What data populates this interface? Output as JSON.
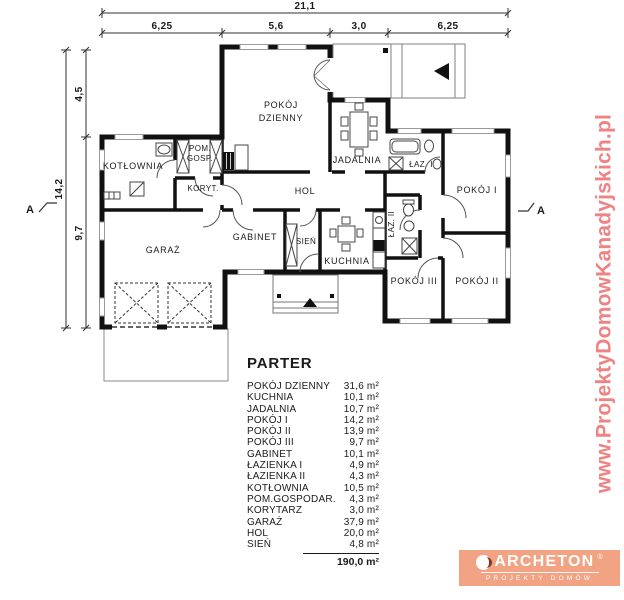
{
  "plan": {
    "rooms": {
      "pokoj_dzienny": {
        "line1": "POKÓJ",
        "line2": "DZIENNY"
      },
      "jadalnia": "JADALNIA",
      "kotlownia": "KOTŁOWNIA",
      "pom_gosp": {
        "line1": "POM.",
        "line2": "GOSP."
      },
      "koryt": "KORYT.",
      "hol": "HOL",
      "garaz": "GARAŻ",
      "gabinet": "GABINET",
      "sien": "SIEŃ",
      "kuchnia": "KUCHNIA",
      "laz1": "ŁAZ. I",
      "laz2": "ŁAZ. II",
      "pokoj1": "POKÓJ I",
      "pokoj2": "POKÓJ II",
      "pokoj3": "POKÓJ III"
    }
  },
  "dimensions": {
    "top_total": "21,1",
    "top_segments": [
      "6,25",
      "5,6",
      "3,0",
      "6,25"
    ],
    "left_total": "14,2",
    "left_segments": [
      "4,5",
      "9,7"
    ],
    "section_marker": "A"
  },
  "table": {
    "title": "PARTER",
    "rows": [
      {
        "label": "POKÓJ DZIENNY",
        "area": "31,6 m²"
      },
      {
        "label": "KUCHNIA",
        "area": "10,1 m²"
      },
      {
        "label": "JADALNIA",
        "area": "10,7 m²"
      },
      {
        "label": "POKÓJ I",
        "area": "14,2 m²"
      },
      {
        "label": "POKÓJ II",
        "area": "13,9 m²"
      },
      {
        "label": "POKÓJ III",
        "area": "9,7 m²"
      },
      {
        "label": "GABINET",
        "area": "10,1 m²"
      },
      {
        "label": "ŁAZIENKA I",
        "area": "4,9 m²"
      },
      {
        "label": "ŁAZIENKA II",
        "area": "4,3 m²"
      },
      {
        "label": "KOTŁOWNIA",
        "area": "10,5 m²"
      },
      {
        "label": "POM.GOSPODAR.",
        "area": "4,3 m²"
      },
      {
        "label": "KORYTARZ",
        "area": "3,0 m²"
      },
      {
        "label": "GARAŻ",
        "area": "37,9 m²"
      },
      {
        "label": "HOL",
        "area": "20,0 m²"
      },
      {
        "label": "SIEŃ",
        "area": "4,8 m²"
      }
    ],
    "total": "190,0 m²"
  },
  "watermark": {
    "text": "www.ProjektyDomowKanadyjskich.pl",
    "color": "#ee8383"
  },
  "logo": {
    "name": "ARCHETON",
    "registered": "®",
    "tagline": "PROJEKTY DOMÓW",
    "bg_color": "#f2a383"
  }
}
